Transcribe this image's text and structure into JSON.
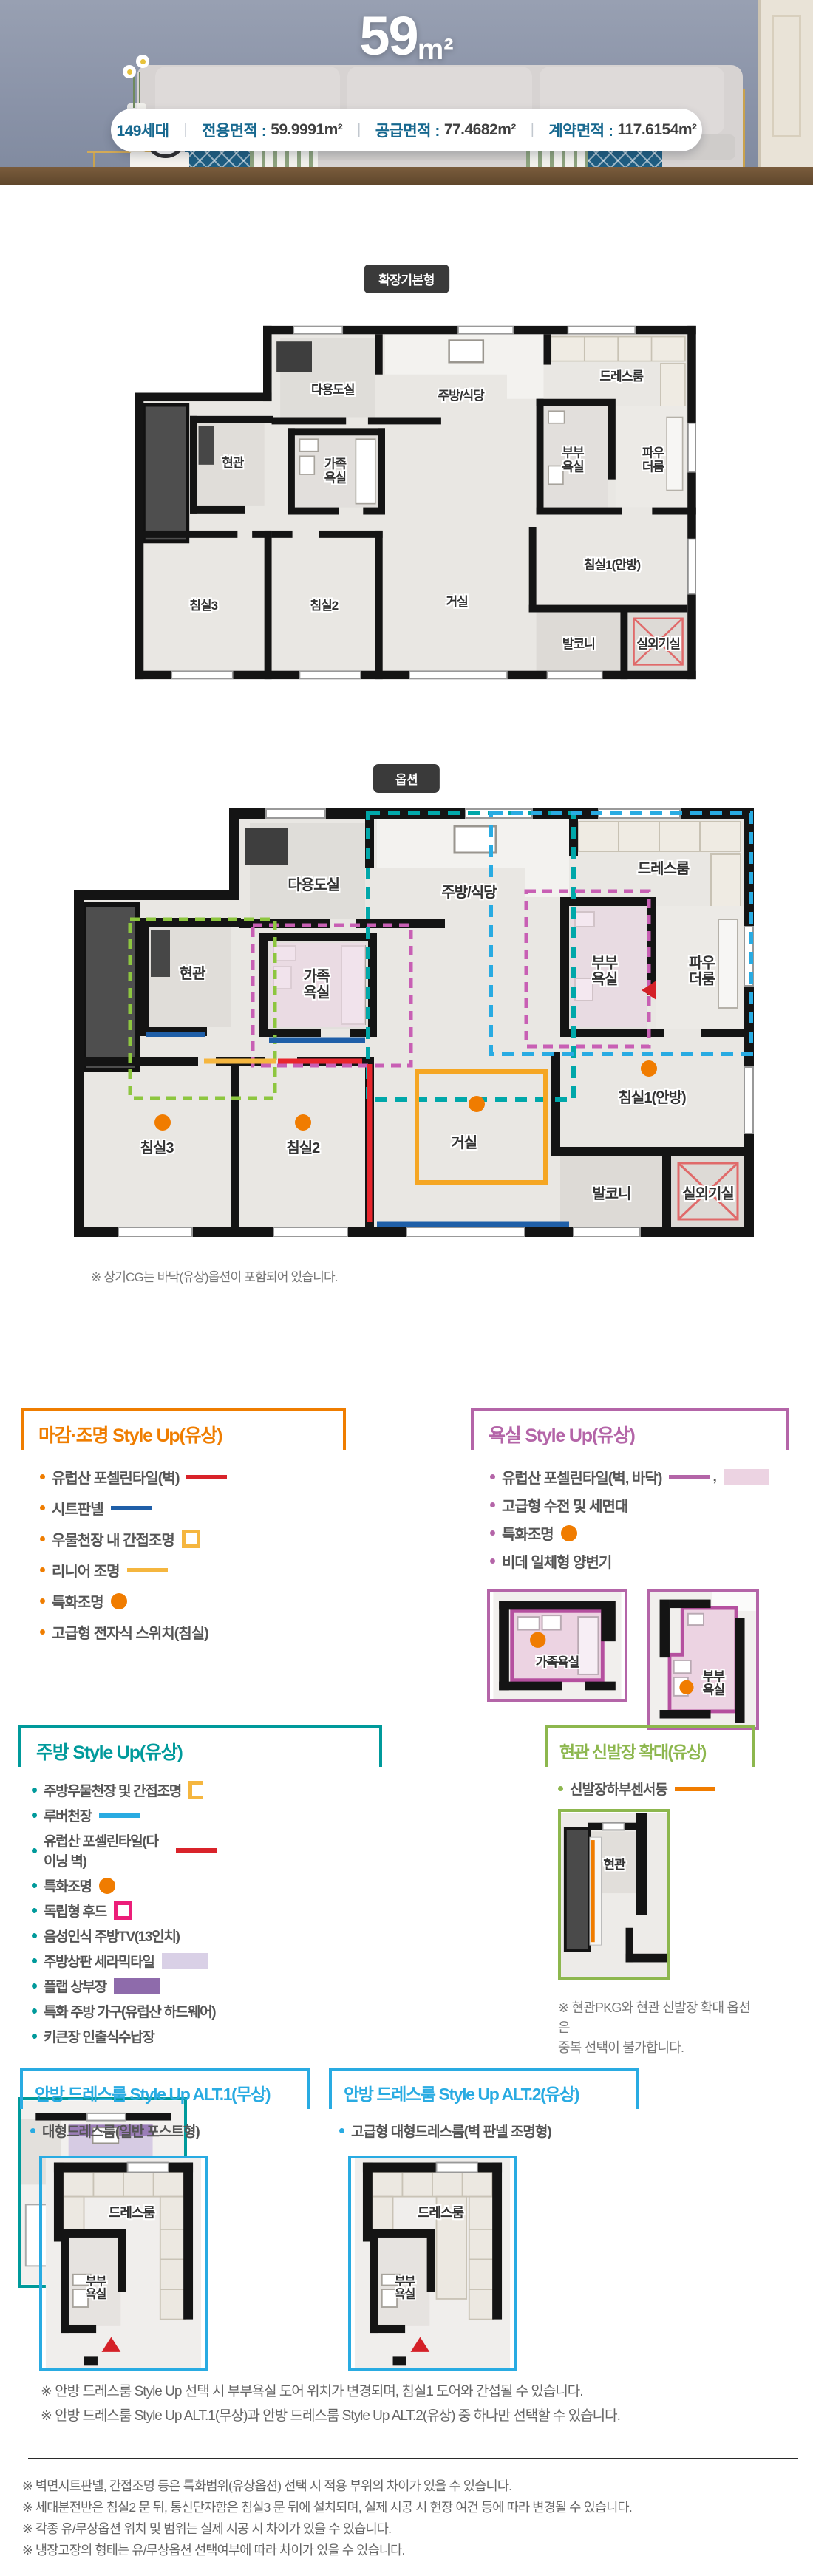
{
  "palette": {
    "accent_finish": "#ef7d00",
    "accent_bath": "#b465a8",
    "accent_kitchen": "#009a9b",
    "accent_entrance": "#8db74e",
    "accent_dress": "#29abe2",
    "info_label_color": "#17688f",
    "badge_bg": "#3a3a3a",
    "legend_red": "#d9232a",
    "legend_blue": "#1f5fa8",
    "legend_yellow": "#f5b63f",
    "legend_orange": "#f07c00",
    "legend_skyblue": "#29abe2",
    "legend_pink": "#ec1e79",
    "legend_lavender": "#d9d0e6",
    "legend_purple": "#8e6bab",
    "legend_pink_tile": "#ecd3e2"
  },
  "hero": {
    "area_number": "59",
    "area_unit": "m²"
  },
  "info_bar": {
    "households": "149세대",
    "divider": "|",
    "areas": [
      {
        "label": "전용면적 :",
        "value": "59.9991m²"
      },
      {
        "label": "공급면적 :",
        "value": "77.4682m²"
      },
      {
        "label": "계약면적 :",
        "value": "117.6154m²"
      }
    ]
  },
  "badges": {
    "basic": "확장기본형",
    "option": "옵션"
  },
  "plan": {
    "rooms": {
      "utility": "다용도실",
      "kitchen": "주방/식당",
      "dress": "드레스룸",
      "entry": "현관",
      "family_bath": "가족\n욕실",
      "master_bath": "부부\n욕실",
      "powder": "파우\n더룸",
      "bed1": "침실1(안방)",
      "living": "거실",
      "bed2": "침실2",
      "bed3": "침실3",
      "balcony": "발코니",
      "ac_room": "실외기실"
    },
    "note": "※ 상기CG는 바닥(유상)옵션이 포함되어 있습니다."
  },
  "sections": {
    "finish": {
      "title": "마감·조명 Style Up(유상)",
      "items": [
        {
          "text": "유럽산 포셀린타일(벽)",
          "legend": "red-line"
        },
        {
          "text": "시트판넬",
          "legend": "blue-line"
        },
        {
          "text": "우물천장 내 간접조명",
          "legend": "yellow-square"
        },
        {
          "text": "리니어 조명",
          "legend": "yellow-line"
        },
        {
          "text": "특화조명",
          "legend": "orange-dot"
        },
        {
          "text": "고급형 전자식 스위치(침실)",
          "legend": ""
        }
      ]
    },
    "bath": {
      "title": "욕실 Style Up(유상)",
      "legend_comma": ",",
      "items": [
        {
          "text": "유럽산 포셀린타일(벽, 바닥)",
          "legend": "purple-line,pink-swatch"
        },
        {
          "text": "고급형 수전 및 세면대",
          "legend": ""
        },
        {
          "text": "특화조명",
          "legend": "orange-dot"
        },
        {
          "text": "비데 일체형 양변기",
          "legend": ""
        }
      ],
      "images": [
        {
          "label": "가족욕실"
        },
        {
          "label": "부부\n욕실"
        }
      ]
    },
    "kitchen": {
      "title": "주방 Style Up(유상)",
      "items": [
        {
          "text": "주방우물천장 및 간접조명",
          "legend": "yellow-bracket"
        },
        {
          "text": "루버천장",
          "legend": "skyblue-line"
        },
        {
          "text": "유럽산 포셀린타일(다이닝 벽)",
          "legend": "red-line"
        },
        {
          "text": "특화조명",
          "legend": "orange-dot"
        },
        {
          "text": "독립형 후드",
          "legend": "pink-square"
        },
        {
          "text": "음성인식 주방TV(13인치)",
          "legend": ""
        },
        {
          "text": "주방상판 세라믹타일",
          "legend": "lavender-swatch"
        },
        {
          "text": "플랩 상부장",
          "legend": "purple-swatch"
        },
        {
          "text": "특화 주방 가구(유럽산 하드웨어)",
          "legend": ""
        },
        {
          "text": "키큰장 인출식수납장",
          "legend": ""
        }
      ]
    },
    "entrance": {
      "title": "현관 신발장 확대(유상)",
      "items": [
        {
          "text": "신발장하부센서등",
          "legend": "orange-line"
        }
      ],
      "note": "※ 현관PKG와 현관 신발장 확대 옵션은\n중복 선택이 불가합니다."
    },
    "dress_alt1": {
      "title": "안방 드레스룸 Style Up ALT.1(무상)",
      "items": [
        {
          "text": "대형드레스룸(일반 포스트형)",
          "legend": ""
        }
      ]
    },
    "dress_alt2": {
      "title": "안방 드레스룸 Style Up ALT.2(유상)",
      "items": [
        {
          "text": "고급형 대형드레스룸(벽 판넬 조명형)",
          "legend": ""
        }
      ]
    }
  },
  "alt_notes": [
    "※ 안방 드레스룸 Style Up 선택 시 부부욕실 도어 위치가 변경되며, 침실1 도어와 간섭될 수 있습니다.",
    "※ 안방 드레스룸 Style Up ALT.1(무상)과 안방 드레스룸 Style Up ALT.2(유상) 중 하나만 선택할 수 있습니다."
  ],
  "bottom_notes": [
    "※ 벽면시트판넬, 간접조명 등은 특화범위(유상옵션) 선택 시 적용 부위의 차이가 있을 수 있습니다.",
    "※ 세대분전반은 침실2 문 뒤, 통신단자함은 침실3 문 뒤에 설치되며, 실제 시공 시 현장 여건 등에 따라 변경될 수 있습니다.",
    "※ 각종 유/무상옵션 위치 및 범위는 실제 시공 시 차이가 있을 수 있습니다.",
    "※ 냉장고장의 형태는 유/무상옵션 선택여부에 따라 차이가 있을 수 있습니다."
  ]
}
